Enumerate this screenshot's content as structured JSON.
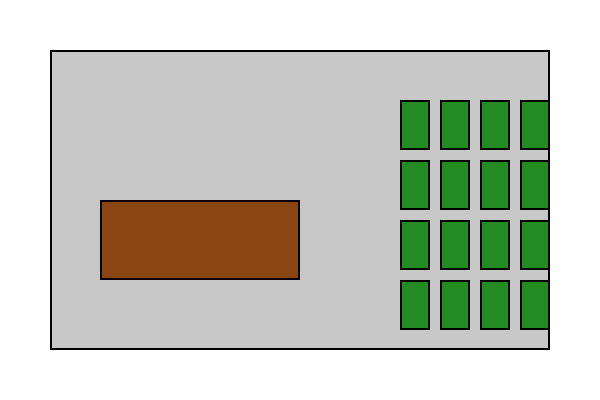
{
  "canvas": {
    "width": 600,
    "height": 400,
    "background": "#FFFFFF"
  },
  "panel": {
    "x": 50,
    "y": 50,
    "width": 500,
    "height": 300,
    "fill": "#C8C8C8",
    "stroke": "#000000"
  },
  "brown_block": {
    "x": 100,
    "y": 200,
    "width": 200,
    "height": 80,
    "fill": "#8B4513",
    "stroke": "#000000"
  },
  "green_grid": {
    "columns_x": [
      400,
      440,
      480,
      520
    ],
    "rows_y": [
      100,
      160,
      220,
      280
    ],
    "cell_width": 30,
    "cell_height": 50,
    "num_cells": 16,
    "fill": "#228B22",
    "stroke": "#000000"
  }
}
